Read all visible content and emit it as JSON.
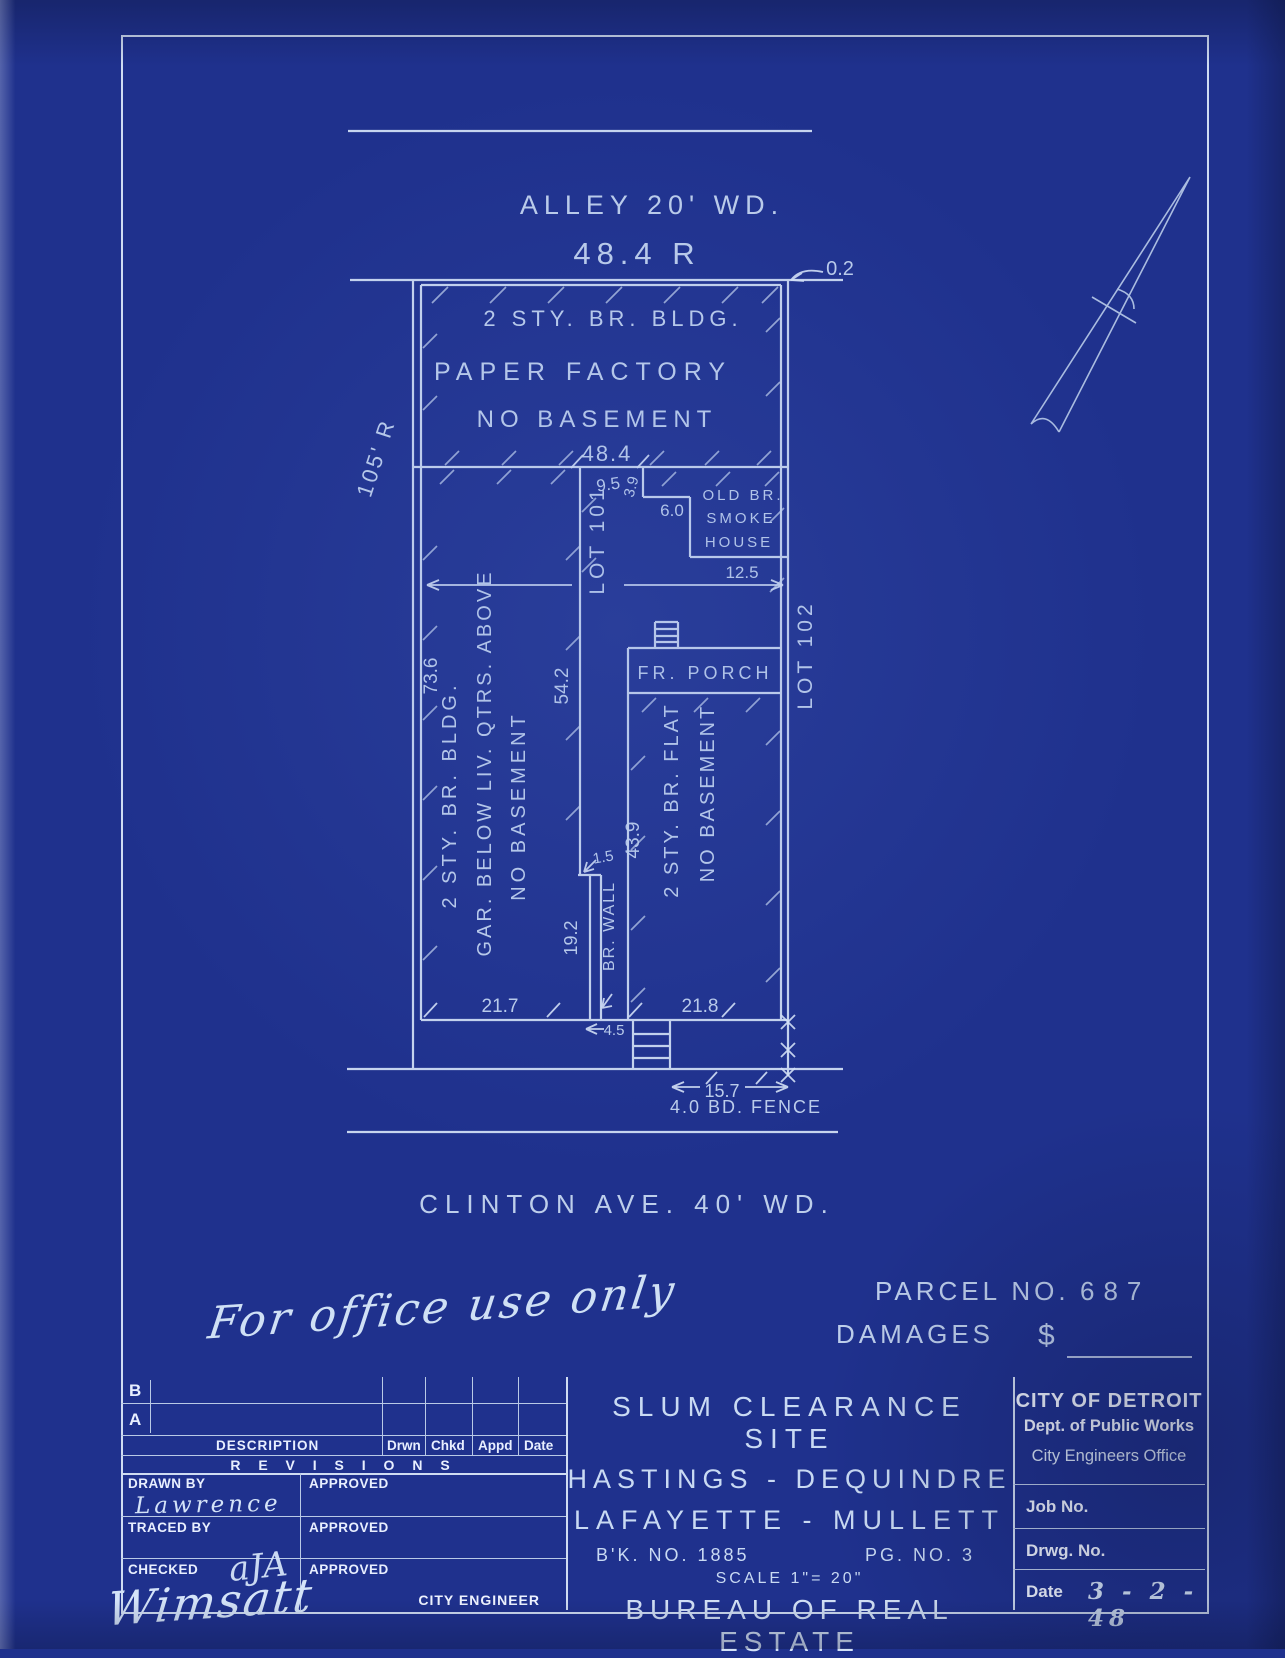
{
  "drawing": {
    "alley_label": "ALLEY 20' WD.",
    "alley_frontage": "48.4 R",
    "corner_offset": "0.2",
    "lot_depth": "105' R",
    "lot101": "LOT 101",
    "lot102": "LOT 102",
    "factory": {
      "line1": "2 STY. BR. BLDG.",
      "line2": "PAPER FACTORY",
      "line3": "NO BASEMENT",
      "width": "48.4"
    },
    "smokehouse": {
      "dim_top": "9.5",
      "dim_side": "3.9",
      "dim_step": "6.0",
      "line1": "OLD BR.",
      "line2": "SMOKE",
      "line3": "HOUSE",
      "dim_bottom": "12.5"
    },
    "garage": {
      "dim_length": "73.6",
      "line1": "2 STY. BR. BLDG.",
      "line2": "GAR. BELOW  LIV. QTRS. ABOVE",
      "line3": "NO BASEMENT",
      "front_width": "21.7"
    },
    "party_wall": {
      "offset": "1.5",
      "length": "19.2",
      "label": "BR. WALL",
      "gap": "4.5",
      "side_dim": "54.2"
    },
    "flat": {
      "porch": "FR. PORCH",
      "depth": "43.9",
      "line1": "2 STY. BR. FLAT",
      "line2": "NO BASEMENT",
      "front_width": "21.8"
    },
    "front": {
      "steps_dim": "15.7",
      "fence": "4.0 BD. FENCE"
    },
    "street": "CLINTON  AVE.  40' WD."
  },
  "office": {
    "parcel_label": "PARCEL  NO.",
    "parcel_no": "687",
    "damages_label": "DAMAGES",
    "dollar": "$",
    "note": "For office use only"
  },
  "titleblock": {
    "revisions": {
      "row_b": "B",
      "row_a": "A",
      "description": "DESCRIPTION",
      "col1": "Drwn",
      "col2": "Chkd",
      "col3": "Appd",
      "col4": "Date",
      "title": "R E V I S I O N S"
    },
    "signoff": {
      "drawn_by": "DRAWN BY",
      "drawn_name": "Lawrence",
      "traced_by": "TRACED BY",
      "checked": "CHECKED",
      "checked_initials": "aJA",
      "signature": "Wimsatt",
      "approved": "APPROVED",
      "city_engineer": "CITY ENGINEER"
    },
    "project": {
      "line1": "SLUM CLEARANCE SITE",
      "line2": "HASTINGS - DEQUINDRE",
      "line3": "LAFAYETTE - MULLETT",
      "book": "B'K. NO. 1885",
      "page": "PG. NO. 3",
      "scale": "SCALE 1\"= 20\"",
      "bureau": "BUREAU OF REAL ESTATE"
    },
    "agency": {
      "city": "CITY OF DETROIT",
      "dept": "Dept. of Public Works",
      "office": "City Engineers Office",
      "job": "Job No.",
      "drwg": "Drwg. No.",
      "date_label": "Date",
      "date": "3 - 2 - 48"
    }
  }
}
